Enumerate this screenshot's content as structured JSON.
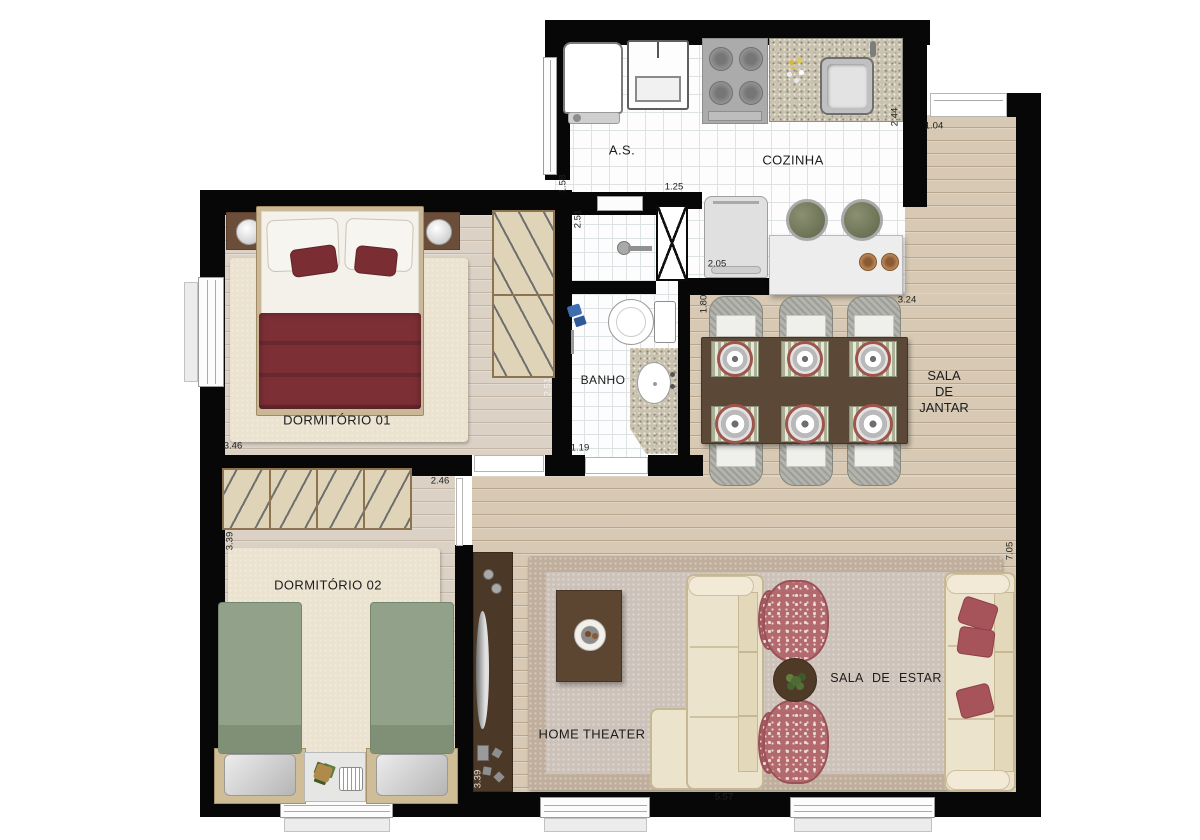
{
  "rooms": {
    "as": "A.S.",
    "cozinha": "COZINHA",
    "banho": "BANHO",
    "dorm1": "DORMITÓRIO 01",
    "dorm2": "DORMITÓRIO 02",
    "jantar1": "SALA",
    "jantar2": "DE",
    "jantar3": "JANTAR",
    "estar": "SALA DE ESTAR",
    "home": "HOME THEATER"
  },
  "measurements": {
    "as_height": "1.58",
    "banho_top_width": "1.25",
    "banho_height_a": "2.51",
    "banho_height_b": "2.51",
    "cozinha_lower": "2.05",
    "cozinha_right": "2.44",
    "entry_door": "1.04",
    "jantar_left": "1.80",
    "jantar_top": "3.24",
    "dorm1_width": "3.46",
    "banho_bottom_width": "1.19",
    "dorm2_door": "2.46",
    "dorm2_height": "3.39",
    "tv_wall": "3.39",
    "estar_width": "5.57",
    "right_side_height": "7.05"
  }
}
